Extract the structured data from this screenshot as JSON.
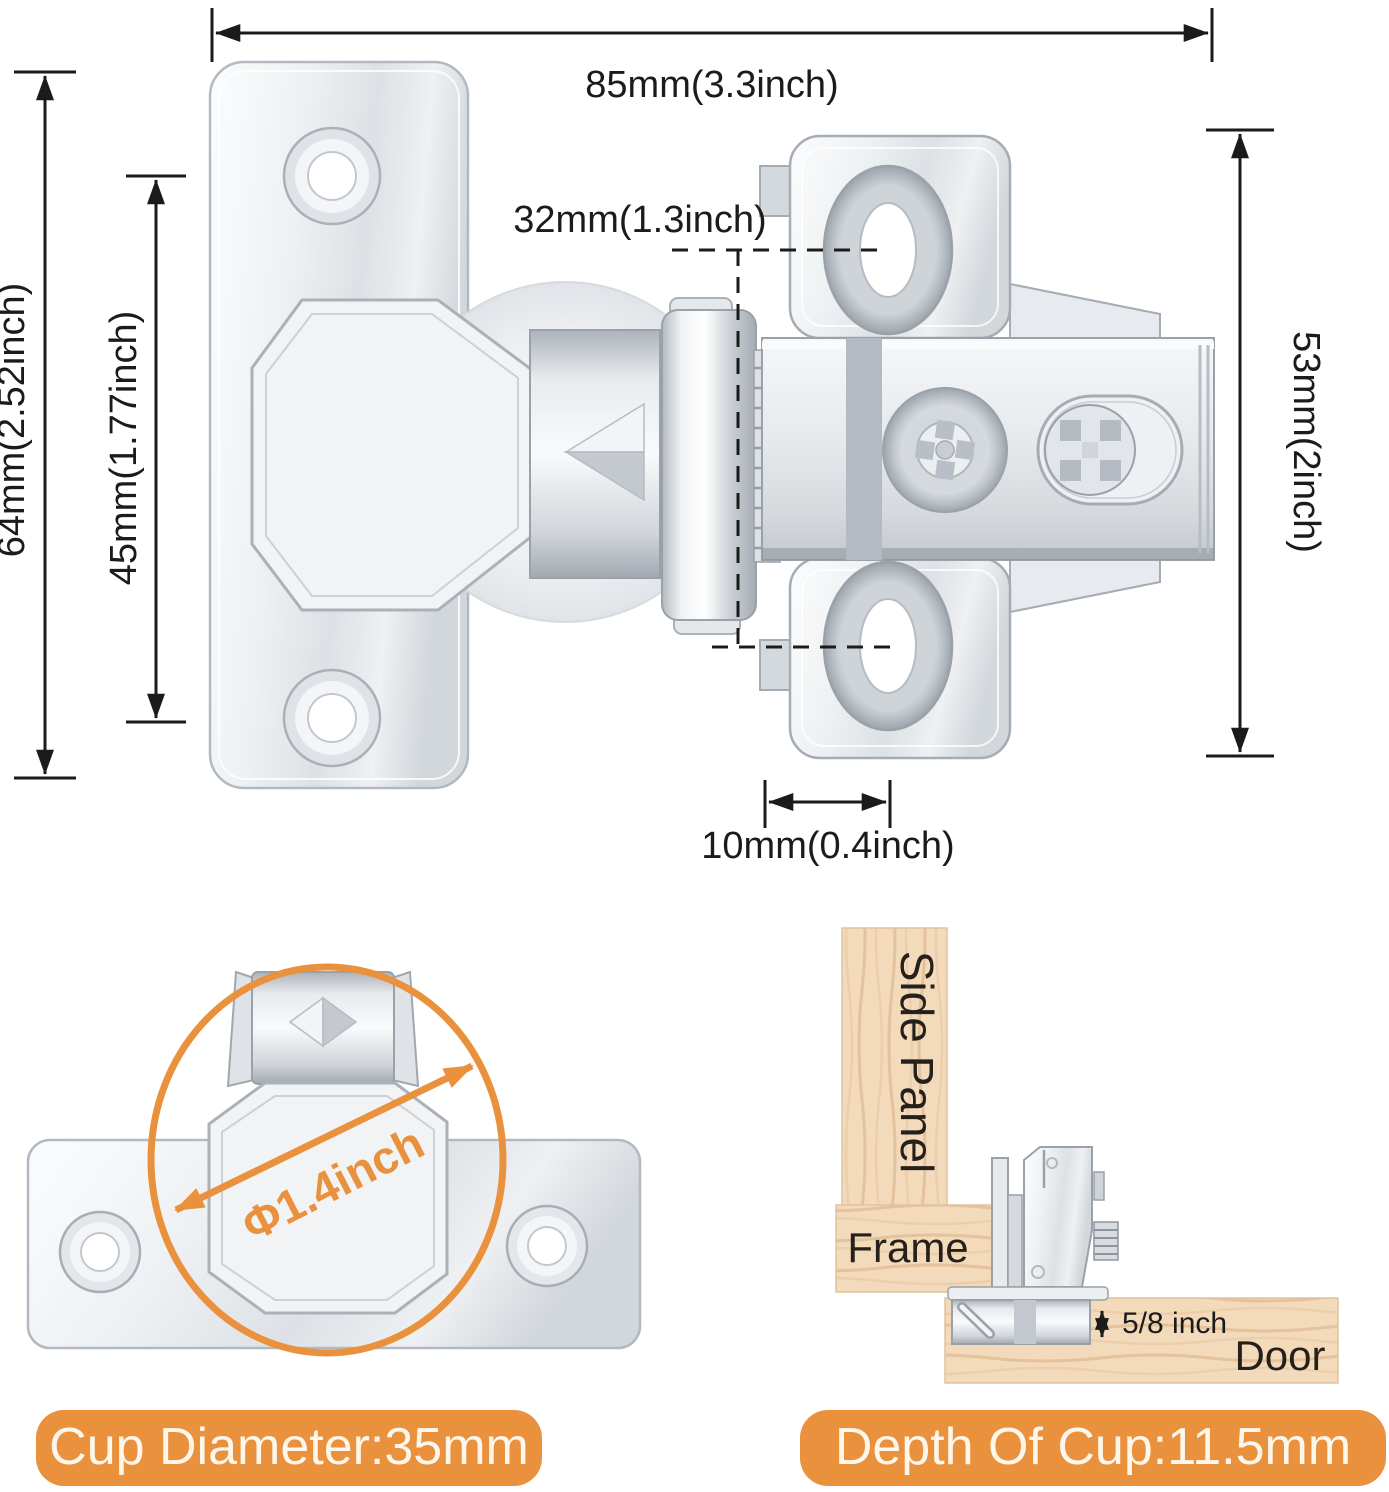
{
  "title": "Concealed cabinet hinge dimension diagram",
  "colors": {
    "accent_orange": "#e9913d",
    "dimension_line": "#1b1b1b",
    "wood_base": "#f3dabb",
    "wood_grain": "#e4c29c",
    "metal_light": "#f6f8fa",
    "metal_mid": "#d9dde2",
    "metal_dark": "#a6adb4",
    "badge_text": "#fdf6ea"
  },
  "main_diagram": {
    "width_label": "85mm(3.3inch)",
    "plate_height_label": "64mm(2.52inch)",
    "door_hole_spacing_label": "45mm(1.77inch)",
    "mounting_hole_spacing_label": "32mm(1.3inch)",
    "mounting_plate_height_label": "53mm(2inch)",
    "offset_label": "10mm(0.4inch)"
  },
  "cup_view": {
    "diameter_arrow_label": "Φ1.4inch",
    "badge_label": "Cup Diameter:35mm"
  },
  "installation_view": {
    "side_panel_label": "Side Panel",
    "frame_label": "Frame",
    "door_label": "Door",
    "overlay_label": "5/8 inch",
    "badge_label": "Depth Of Cup:11.5mm"
  }
}
